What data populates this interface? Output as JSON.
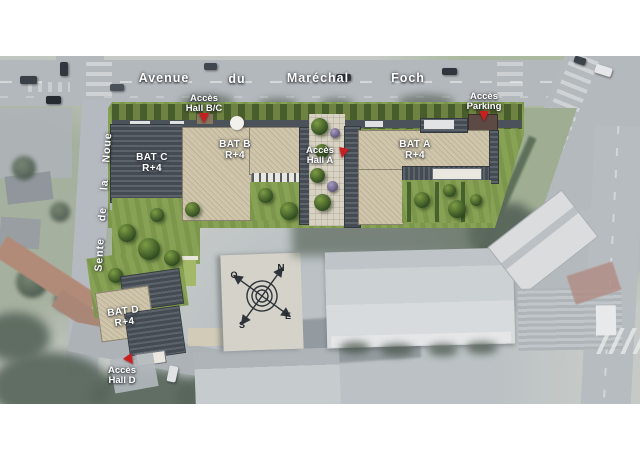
{
  "streets": {
    "avenue_words": [
      "Avenue",
      "du",
      "Maréchal",
      "Foch"
    ],
    "side_street": "Sente de la Noue"
  },
  "buildings": [
    {
      "name": "BAT C",
      "floors": "R+4"
    },
    {
      "name": "BAT B",
      "floors": "R+4"
    },
    {
      "name": "BAT A",
      "floors": "R+4"
    },
    {
      "name": "BAT D",
      "floors": "R+4"
    }
  ],
  "access_points": [
    {
      "line1": "Accès",
      "line2": "Hall B/C"
    },
    {
      "line1": "Accès",
      "line2": "Parking"
    },
    {
      "line1": "Accès",
      "line2": "Hall A"
    },
    {
      "line1": "Accès",
      "line2": "Hall D"
    }
  ],
  "compass": {
    "north": "N",
    "east": "E",
    "south": "S",
    "west": "O"
  },
  "colors": {
    "marker_red": "#c82020",
    "roof_dark": "#4d535b",
    "roof_beige": "#cdc3a8",
    "lawn_green": "#87a254",
    "label_white": "#ffffff"
  }
}
